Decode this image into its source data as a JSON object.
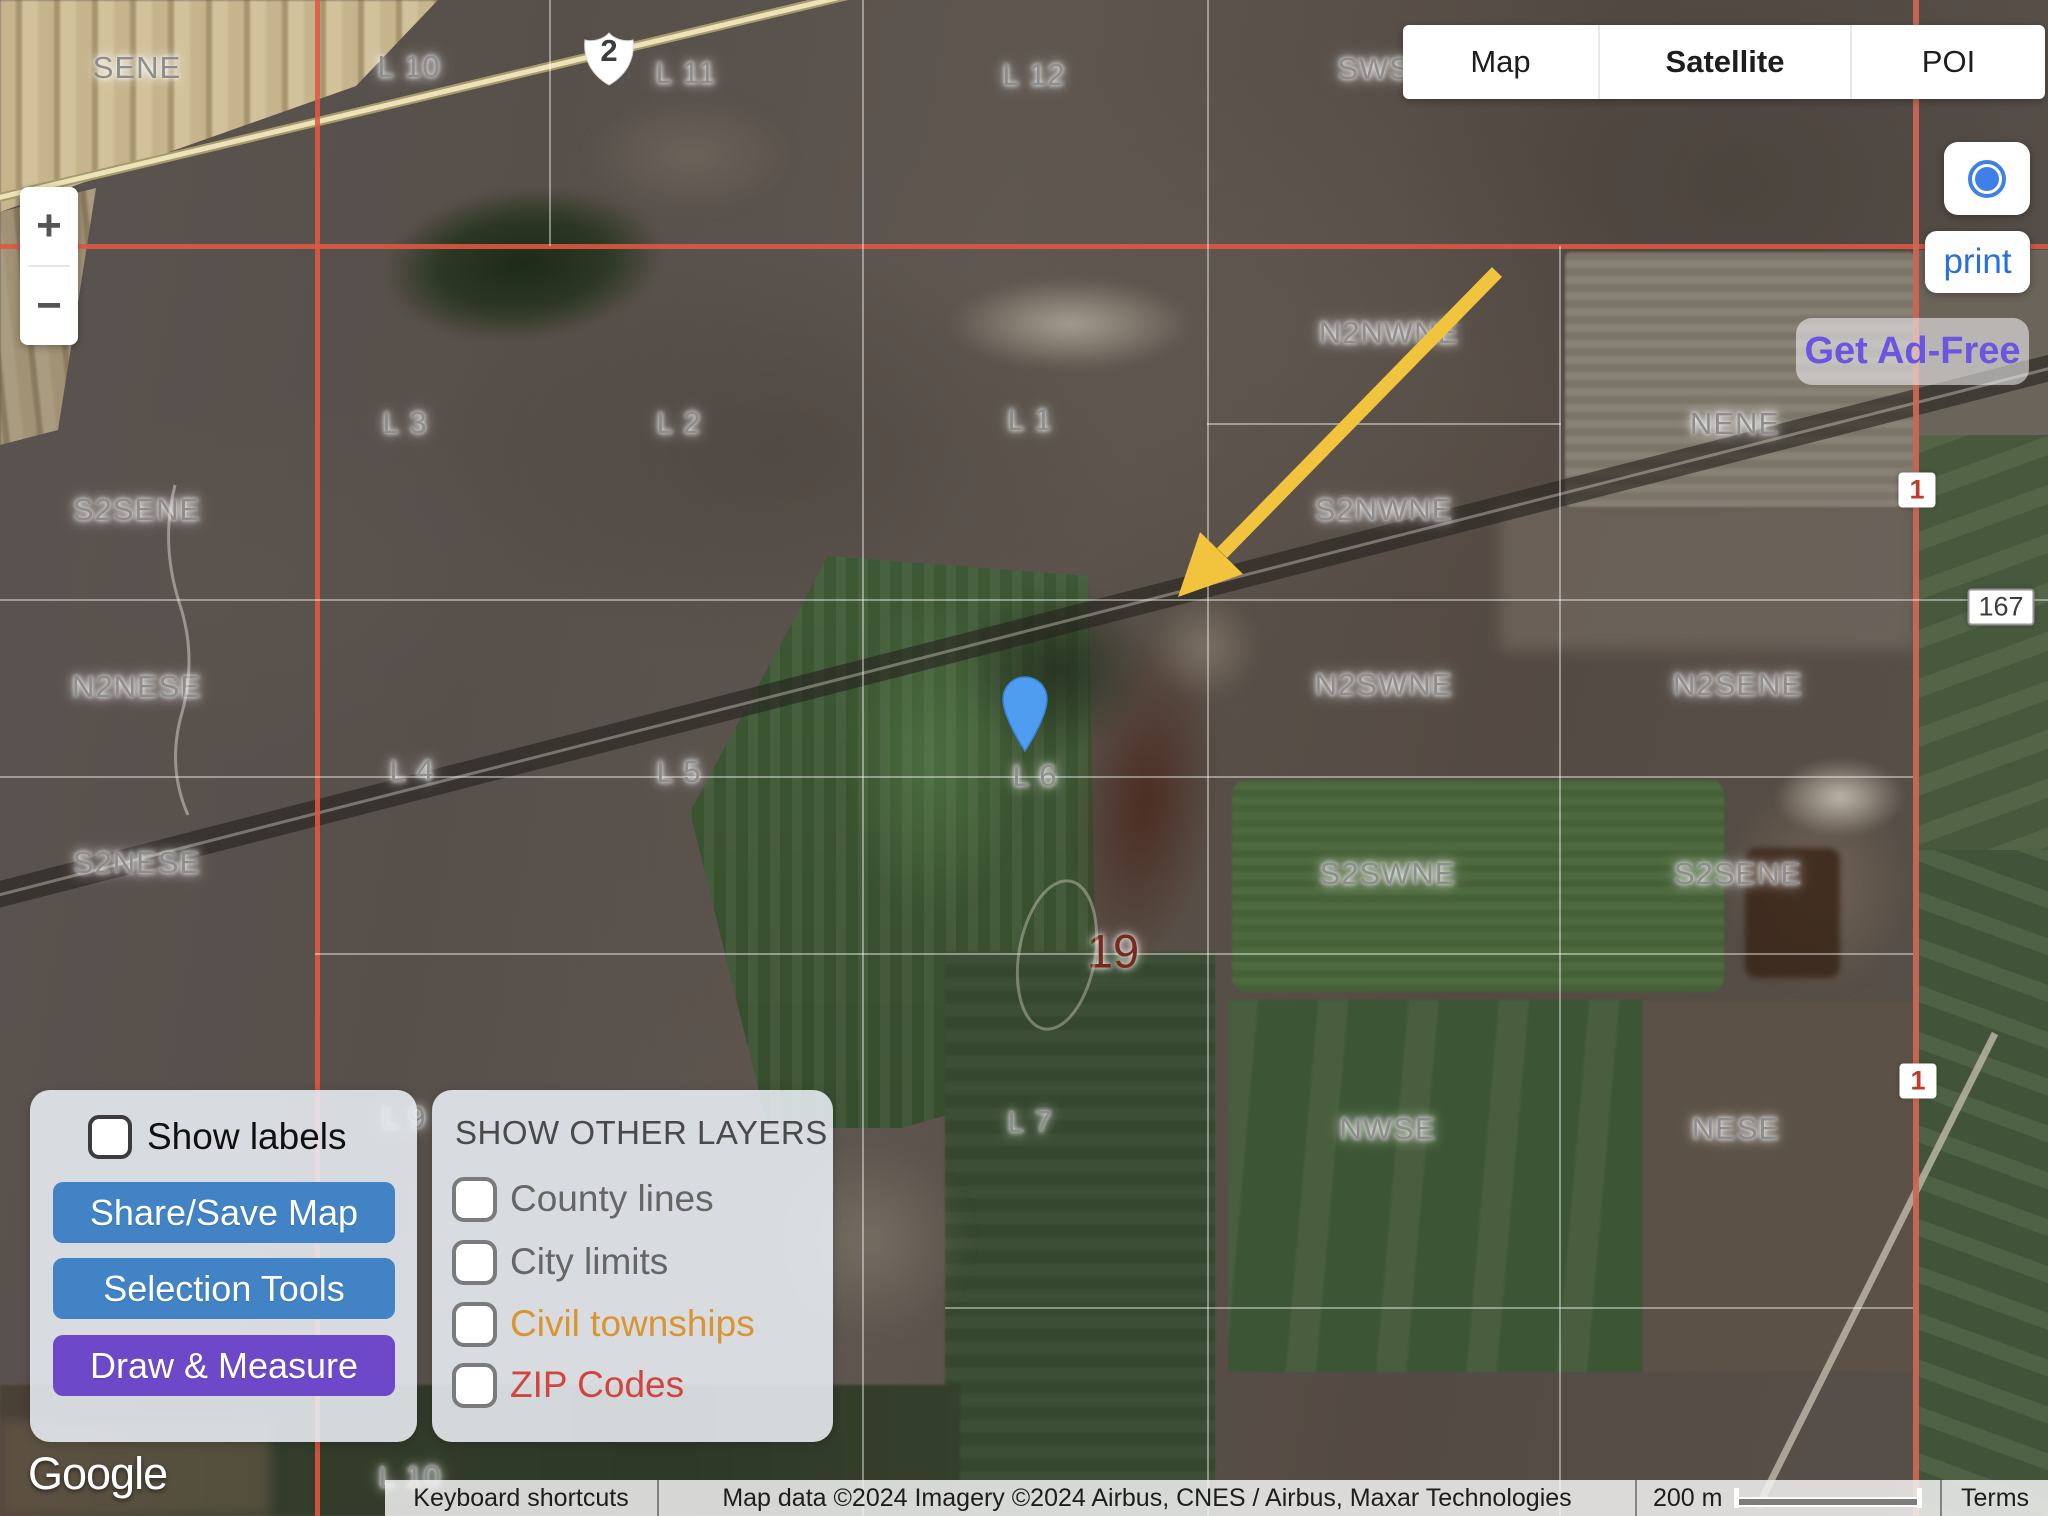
{
  "map_type_control": {
    "items": [
      {
        "label": "Map",
        "active": false
      },
      {
        "label": "Satellite",
        "active": true
      },
      {
        "label": "POI",
        "active": false
      }
    ]
  },
  "zoom_control": {
    "zoom_in": "+",
    "zoom_out": "−"
  },
  "print_button": {
    "label": "print"
  },
  "ad_free_button": {
    "label": "Get Ad-Free",
    "color": "#6c55e0"
  },
  "tools_panel": {
    "show_labels_label": "Show labels",
    "show_labels_checked": false,
    "buttons": [
      {
        "label": "Share/Save Map",
        "bg": "#4183c4"
      },
      {
        "label": "Selection Tools",
        "bg": "#4183c4"
      },
      {
        "label": "Draw & Measure",
        "bg": "#6d49c9"
      }
    ]
  },
  "layers_panel": {
    "title": "SHOW OTHER LAYERS",
    "items": [
      {
        "label": "County lines",
        "color": "#666666",
        "checked": false
      },
      {
        "label": "City limits",
        "color": "#666666",
        "checked": false
      },
      {
        "label": "Civil townships",
        "color": "#d9952f",
        "checked": false
      },
      {
        "label": "ZIP Codes",
        "color": "#d2453c",
        "checked": false
      }
    ]
  },
  "attribution": {
    "google_logo": "Google",
    "keyboard_shortcuts": "Keyboard shortcuts",
    "map_data": "Map data ©2024 Imagery ©2024 Airbus, CNES / Airbus, Maxar Technologies",
    "scale_text": "200 m",
    "terms": "Terms"
  },
  "map": {
    "shield": {
      "text": "2",
      "x": 609,
      "y": 58
    },
    "marker": {
      "x": 1025,
      "y": 752,
      "color": "#4e9df1"
    },
    "arrow": {
      "from": [
        1497,
        272
      ],
      "to": [
        1178,
        597
      ],
      "color": "#f2c43d"
    },
    "grid_colors": {
      "township_line": "#e05840",
      "section_line": "#ffffff"
    },
    "route_markers": [
      {
        "text": "1",
        "x": 1917,
        "y": 490,
        "variant": "red"
      },
      {
        "text": "1",
        "x": 1918,
        "y": 1081,
        "variant": "red"
      },
      {
        "text": "167",
        "x": 2001,
        "y": 607,
        "variant": "dark"
      }
    ],
    "labels": [
      {
        "text": "SENE",
        "x": 137,
        "y": 68
      },
      {
        "text": "L 10",
        "x": 409,
        "y": 67
      },
      {
        "text": "L 11",
        "x": 686,
        "y": 73
      },
      {
        "text": "L 12",
        "x": 1034,
        "y": 75
      },
      {
        "text": "SWSE",
        "x": 1385,
        "y": 69
      },
      {
        "text": "N2NWNE",
        "x": 1389,
        "y": 333
      },
      {
        "text": "NENE",
        "x": 1735,
        "y": 424
      },
      {
        "text": "L 3",
        "x": 405,
        "y": 423
      },
      {
        "text": "L 2",
        "x": 679,
        "y": 423
      },
      {
        "text": "L 1",
        "x": 1030,
        "y": 420
      },
      {
        "text": "S2SENE",
        "x": 137,
        "y": 510
      },
      {
        "text": "S2NWNE",
        "x": 1384,
        "y": 510
      },
      {
        "text": "N2NESE",
        "x": 137,
        "y": 687
      },
      {
        "text": "N2SWNE",
        "x": 1384,
        "y": 685
      },
      {
        "text": "N2SENE",
        "x": 1738,
        "y": 685
      },
      {
        "text": "L 4",
        "x": 412,
        "y": 771
      },
      {
        "text": "L 5",
        "x": 679,
        "y": 772
      },
      {
        "text": "L 6",
        "x": 1035,
        "y": 776
      },
      {
        "text": "S2NESE",
        "x": 137,
        "y": 863
      },
      {
        "text": "S2SWNE",
        "x": 1388,
        "y": 874
      },
      {
        "text": "S2SENE",
        "x": 1738,
        "y": 874
      },
      {
        "text": "19",
        "x": 1113,
        "y": 951,
        "variant": "section-number"
      },
      {
        "text": "L 7",
        "x": 1030,
        "y": 1122
      },
      {
        "text": "NWSE",
        "x": 1388,
        "y": 1129
      },
      {
        "text": "NESE",
        "x": 1736,
        "y": 1129
      },
      {
        "text": "L 9",
        "x": 404,
        "y": 1118
      },
      {
        "text": "L 10",
        "x": 410,
        "y": 1477
      }
    ]
  }
}
